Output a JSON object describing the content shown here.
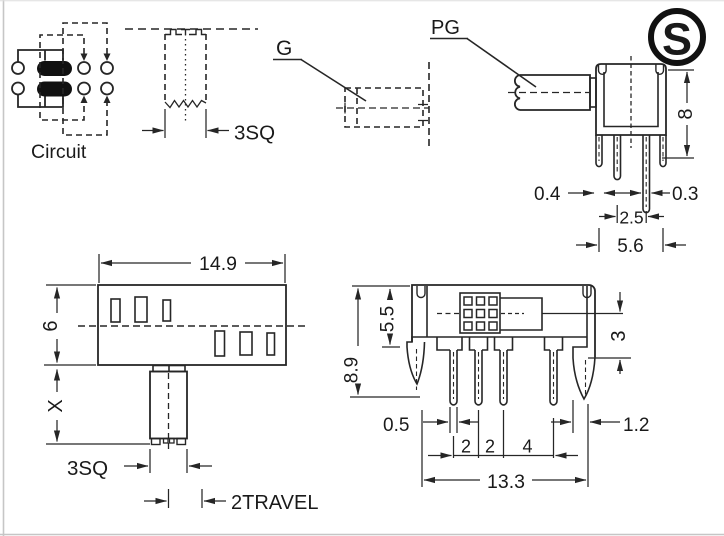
{
  "colors": {
    "line": "#262626",
    "text": "#1a1a1a",
    "contact_fill": "#111111",
    "border": "#c6c6c6"
  },
  "logo": {
    "letter": "S"
  },
  "circuit_view": {
    "caption": "Circuit"
  },
  "shaft_view": {
    "dim_square": "3SQ"
  },
  "g_detail": {
    "label": "G"
  },
  "pg_view": {
    "label": "PG",
    "dim_height": "8",
    "dim_pin_left": "0.4",
    "dim_pin_right": "0.3",
    "dim_pitch": "2.5",
    "dim_span": "5.6"
  },
  "front_view": {
    "dim_width": "14.9",
    "dim_height": "6",
    "dim_shaft_len": "X",
    "dim_square": "3SQ",
    "dim_travel": "2TRAVEL"
  },
  "bottom_view": {
    "dim_height": "8.9",
    "dim_inner_height": "5.5",
    "dim_step": "3",
    "dim_pin_width": "0.5",
    "dim_pitch_a": "2",
    "dim_pitch_b": "2",
    "dim_pitch_c": "4",
    "dim_clip": "1.2",
    "dim_span": "13.3"
  }
}
